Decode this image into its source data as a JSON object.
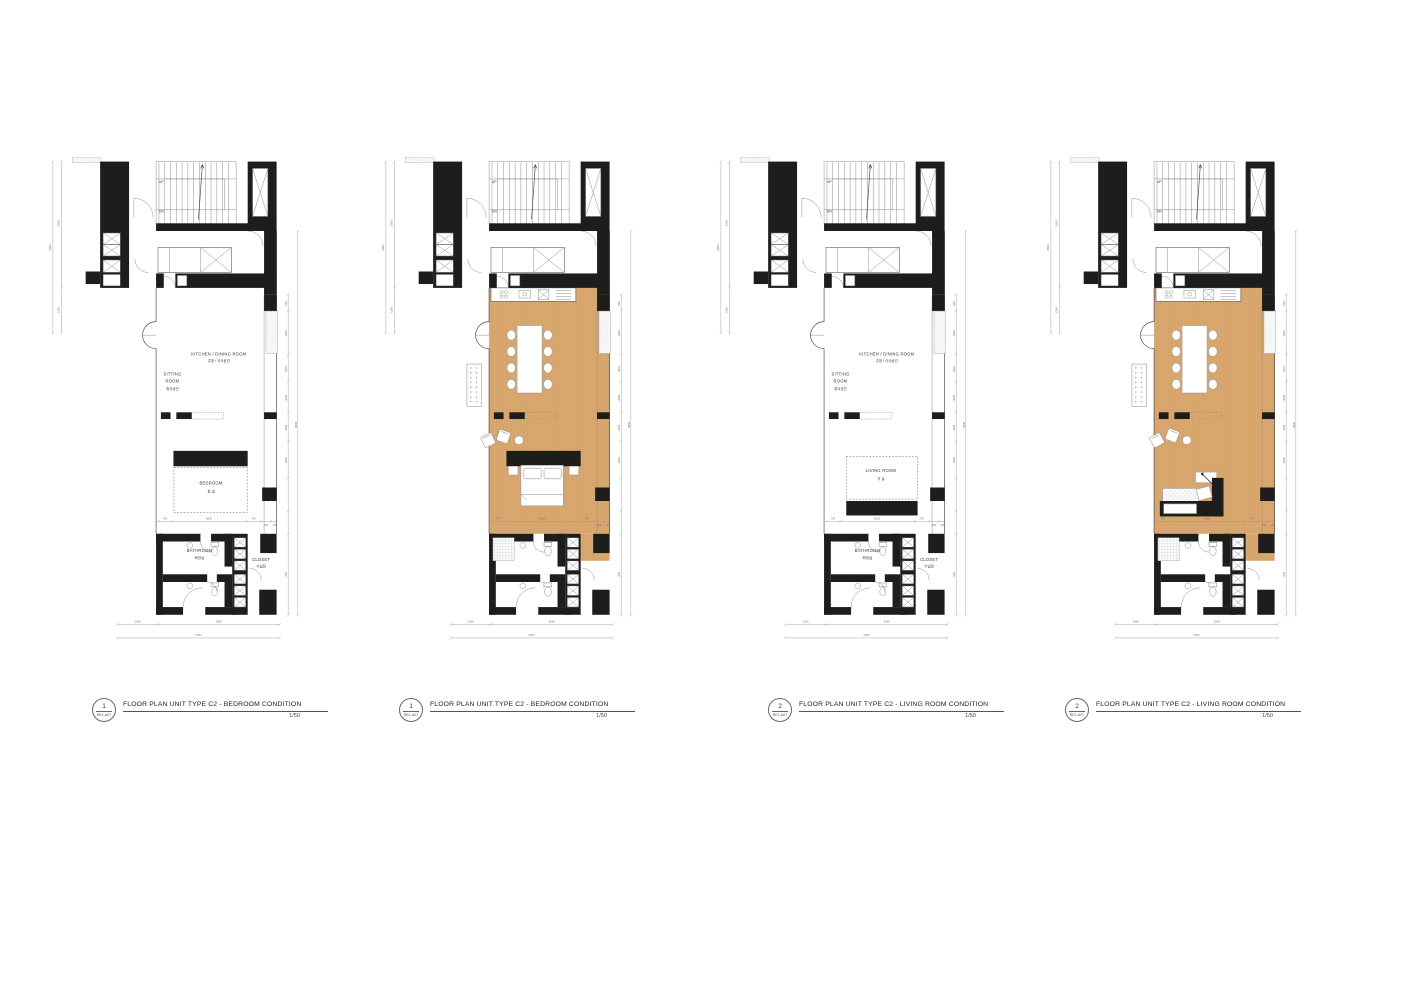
{
  "colors": {
    "wall": "#1d1d1b",
    "wood_floor": "#d9a76e",
    "wood_plank_line": "#b98a50",
    "plan_line": "#4a4a4a",
    "dimension_line": "#9a9a9a",
    "text": "#333333",
    "background": "#ffffff"
  },
  "shared": {
    "up": "UP",
    "dn": "DN",
    "dims": {
      "bottom": [
        "1500",
        "5099",
        "6784"
      ],
      "left": [
        "3000",
        "1500",
        "8800"
      ],
      "right": [
        "600",
        "3005",
        "3051",
        "3005",
        "3045",
        "2549",
        "600"
      ],
      "right_total": "8840",
      "bed_row": [
        "734",
        "5020",
        "734",
        "600",
        "100"
      ]
    }
  },
  "plans": [
    {
      "number": "1",
      "ref": "RE1-A07",
      "title": "FLOOR PLAN UNIT TYPE C2 - BEDROOM CONDITION",
      "scale": "1/50",
      "condition": "bedroom",
      "style": "line",
      "labels": {
        "kitchen": "KITCHEN / DINING ROOM",
        "kitchen_kr": "주방 / 식사공간",
        "sitting_1": "SITTING",
        "sitting_2": "ROOM",
        "sitting_kr": "휴식공간",
        "room": "BEDROOM",
        "room_kr": "침 실",
        "bathroom": "BATHROOM",
        "bathroom_kr": "화장실",
        "closet": "CLOSET",
        "closet_kr": "수납장"
      }
    },
    {
      "number": "1",
      "ref": "RE1-A07",
      "title": "FLOOR PLAN UNIT TYPE C2 - BEDROOM CONDITION",
      "scale": "1/50",
      "condition": "bedroom",
      "style": "rendered"
    },
    {
      "number": "2",
      "ref": "RE1-A07",
      "title": "FLOOR PLAN UNIT TYPE C2 - LIVING ROOM CONDITION",
      "scale": "1/50",
      "condition": "living",
      "style": "line",
      "labels": {
        "kitchen": "KITCHEN / DINING ROOM",
        "kitchen_kr": "주방 / 식사공간",
        "sitting_1": "SITTING",
        "sitting_2": "ROOM",
        "sitting_kr": "휴식공간",
        "room": "LIVING ROOM",
        "room_kr": "거 실",
        "bathroom": "BATHROOM",
        "bathroom_kr": "화장실",
        "closet": "CLOSET",
        "closet_kr": "수납장"
      }
    },
    {
      "number": "2",
      "ref": "RE1-A07",
      "title": "FLOOR PLAN UNIT TYPE C2 - LIVING ROOM CONDITION",
      "scale": "1/50",
      "condition": "living",
      "style": "rendered"
    }
  ]
}
